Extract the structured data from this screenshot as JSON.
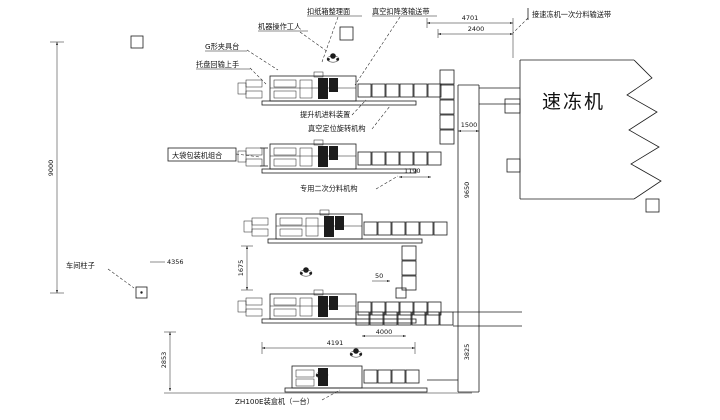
{
  "freezer": {
    "label": "速冻机"
  },
  "annotations": [
    {
      "id": "carton-arrange-surface",
      "text": "扣纸箱整理面"
    },
    {
      "id": "vacuum-drop-conveyor",
      "text": "真空扣降落输送带"
    },
    {
      "id": "machine-operators",
      "text": "机器操作工人"
    },
    {
      "id": "g-clamp-table",
      "text": "G形夹具台"
    },
    {
      "id": "tray-return-hand",
      "text": "托盘回输上手"
    },
    {
      "id": "elevator-feed-device",
      "text": "提升机进料装置"
    },
    {
      "id": "vacuum-rotary-mechanism",
      "text": "真空定位旋转机构"
    },
    {
      "id": "bag-packer-group",
      "text": "大袋包装机组合"
    },
    {
      "id": "secondary-divider",
      "text": "专用二次分料机构"
    },
    {
      "id": "workshop-column",
      "text": "车间柱子"
    },
    {
      "id": "zh100-cartoner",
      "text": "ZH100E装盒机（一台）"
    },
    {
      "id": "freezer-feed-conveyor",
      "text": "接速冻机一次分料输送带"
    }
  ],
  "dimensions": [
    {
      "id": "left-overall-height",
      "value": "9000"
    },
    {
      "id": "top-outer-width",
      "value": "4701"
    },
    {
      "id": "top-inner-width",
      "value": "2400"
    },
    {
      "id": "conveyor-width",
      "value": "1500"
    },
    {
      "id": "right-overall-height",
      "value": "9650"
    },
    {
      "id": "row2-offset",
      "value": "1190"
    },
    {
      "id": "mid-offset",
      "value": "4356"
    },
    {
      "id": "row3-row4-gap",
      "value": "1675"
    },
    {
      "id": "bottom-left-height",
      "value": "2853"
    },
    {
      "id": "row4-length",
      "value": "4191"
    },
    {
      "id": "small-gap",
      "value": "50"
    },
    {
      "id": "lower-conveyor-length",
      "value": "4000"
    },
    {
      "id": "lower-right-height",
      "value": "3825"
    }
  ]
}
